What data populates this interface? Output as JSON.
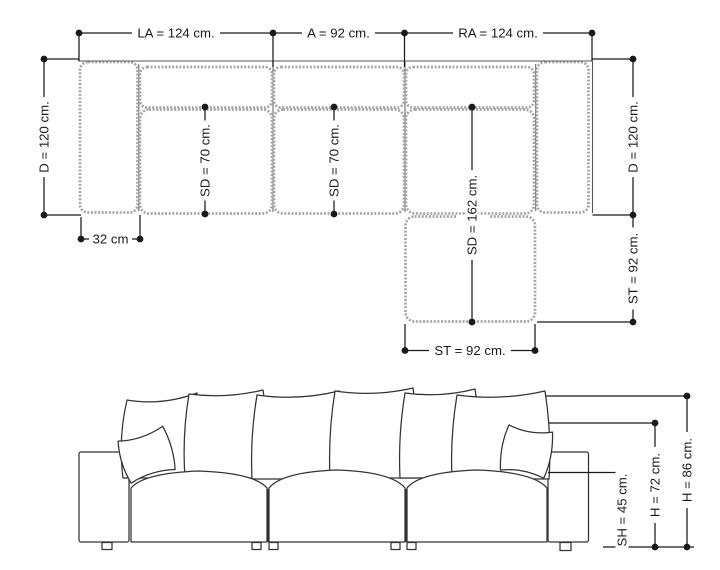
{
  "colors": {
    "line": "#1a1a1a",
    "piping": "#a6a6a6",
    "bg": "#ffffff"
  },
  "plan": {
    "dims": {
      "la": "LA = 124 cm.",
      "a": "A = 92 cm.",
      "ra": "RA = 124 cm.",
      "d_left": "D = 120 cm.",
      "d_right": "D = 120 cm.",
      "arm": "32 cm",
      "sd1": "SD = 70 cm.",
      "sd2": "SD = 70 cm.",
      "sd_chaise": "SD = 162 cm.",
      "st_bottom": "ST = 92 cm.",
      "st_right": "ST = 92 cm."
    }
  },
  "front": {
    "dims": {
      "sh": "SH = 45 cm.",
      "h_back": "H = 72 cm.",
      "h_total": "H = 86 cm."
    }
  }
}
